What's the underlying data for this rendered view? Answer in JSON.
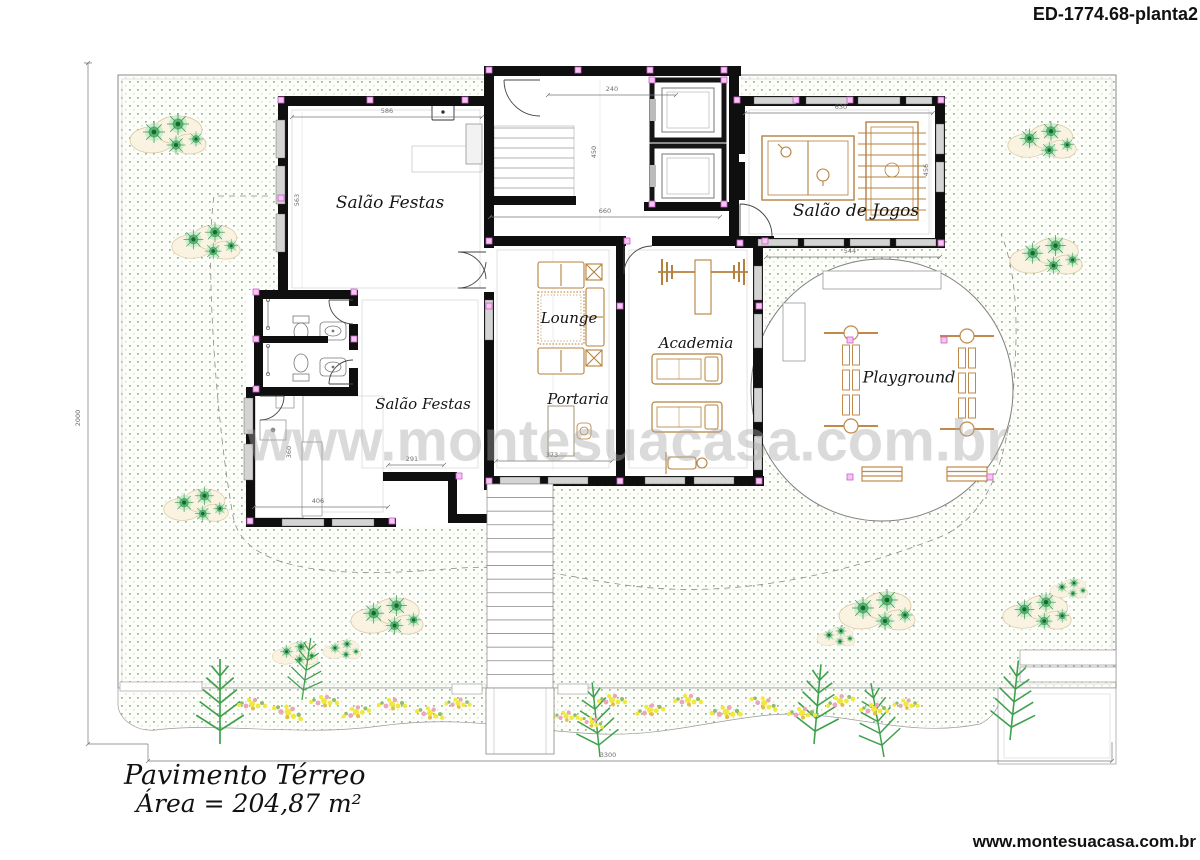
{
  "header": {
    "drawing_code": "ED-1774.68-planta2"
  },
  "plan": {
    "rooms": {
      "salao_festas_top": "Salão Festas",
      "salao_de_jogos": "Salão de Jogos",
      "lounge": "Lounge",
      "academia": "Academia",
      "portaria": "Portaria",
      "playground": "Playground",
      "salao_festas_bottom": "Salão Festas"
    },
    "dimensions": {
      "party_room_width": "586",
      "hall_width": "240",
      "hall_depth": "450",
      "hall_total": "660",
      "games_room_width": "630",
      "games_room_depth": "456",
      "party_room_depth": "563",
      "playground_width": "544",
      "portaria_width": "373",
      "party_room_bottom_width": "291",
      "kitchen_width": "406",
      "kitchen_depth": "360",
      "site_width": "3300",
      "site_depth": "2000"
    },
    "watermark": "www.montesuacasa.com.br"
  },
  "footer": {
    "floor_label": "Pavimento Térreo",
    "area_label": "Área = 204,87 m²",
    "website": "www.montesuacasa.com.br"
  },
  "colors": {
    "wall": "#0f0f0f",
    "furniture": "#b5803c",
    "grass_dot": "#7fbe8d",
    "tree_green": "#2f8f48",
    "node_pink": "#f7c4f3",
    "flower_yellow": "#f0e83a",
    "flower_pink": "#eba6bc"
  }
}
